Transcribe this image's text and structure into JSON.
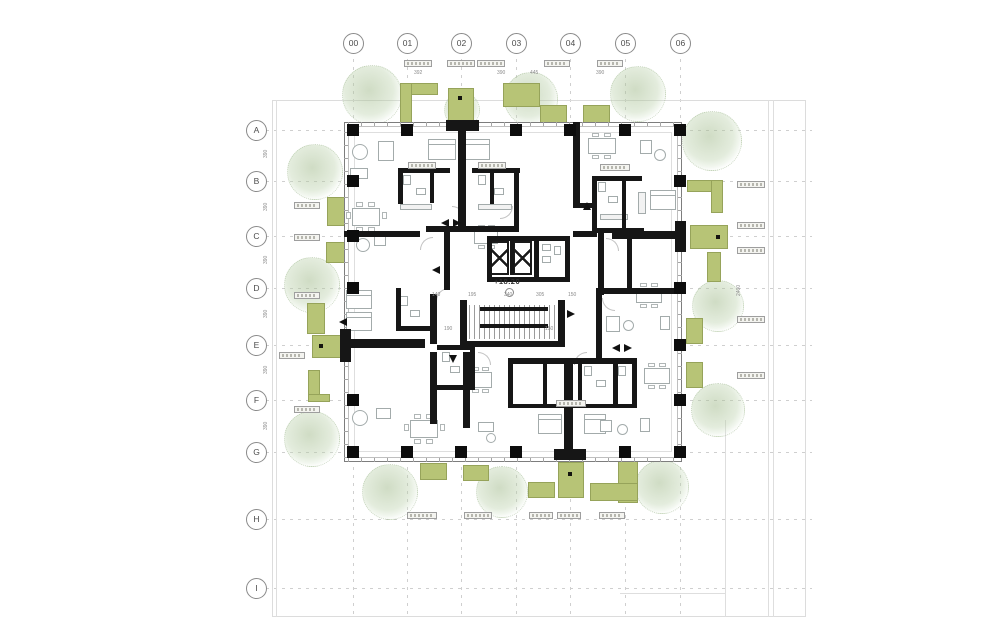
{
  "title": "residential-tower-floor-plan",
  "level_annotation": "+18.20",
  "grid": {
    "cols": [
      "00",
      "01",
      "02",
      "03",
      "04",
      "05",
      "06"
    ],
    "rows": [
      "A",
      "B",
      "C",
      "D",
      "E",
      "F",
      "G",
      "H",
      "I"
    ],
    "col_x": [
      353,
      407,
      461,
      516,
      570,
      625,
      680
    ],
    "row_y": [
      130,
      181,
      236,
      288,
      345,
      400,
      452,
      519,
      588
    ],
    "circle_top_cy": 43,
    "circle_left_cx": 256
  },
  "site": {
    "rect": [
      272,
      100,
      534,
      517
    ],
    "vlines": [
      [
        276,
        100,
        517
      ],
      [
        768,
        100,
        517
      ],
      [
        773,
        100,
        517
      ],
      [
        725,
        420,
        197
      ]
    ],
    "hlines": [
      [
        620,
        593,
        105
      ]
    ]
  },
  "building": {
    "rect": [
      344,
      122,
      338,
      340
    ]
  },
  "columns": [
    [
      407,
      130
    ],
    [
      516,
      130
    ],
    [
      570,
      130
    ],
    [
      625,
      130
    ],
    [
      353,
      130
    ],
    [
      353,
      181
    ],
    [
      353,
      236
    ],
    [
      353,
      288
    ],
    [
      353,
      400
    ],
    [
      353,
      452
    ],
    [
      680,
      130
    ],
    [
      680,
      181
    ],
    [
      680,
      288
    ],
    [
      680,
      345
    ],
    [
      680,
      400
    ],
    [
      680,
      452
    ],
    [
      407,
      452
    ],
    [
      461,
      452
    ],
    [
      516,
      452
    ],
    [
      625,
      452
    ]
  ],
  "walls": [
    [
      446,
      120,
      33,
      11
    ],
    [
      458,
      131,
      8,
      98
    ],
    [
      340,
      329,
      11,
      33
    ],
    [
      351,
      339,
      74,
      9
    ],
    [
      675,
      221,
      11,
      31
    ],
    [
      612,
      231,
      63,
      8
    ],
    [
      554,
      449,
      32,
      11
    ],
    [
      564,
      363,
      9,
      88
    ],
    [
      398,
      168,
      52,
      5
    ],
    [
      472,
      168,
      48,
      5
    ],
    [
      398,
      168,
      5,
      36
    ],
    [
      430,
      173,
      4,
      30
    ],
    [
      490,
      168,
      4,
      36
    ],
    [
      514,
      168,
      5,
      64
    ],
    [
      344,
      231,
      76,
      6
    ],
    [
      426,
      226,
      92,
      6
    ],
    [
      444,
      232,
      6,
      58
    ],
    [
      573,
      122,
      7,
      84
    ],
    [
      573,
      203,
      22,
      5
    ],
    [
      592,
      176,
      50,
      5
    ],
    [
      592,
      176,
      5,
      57
    ],
    [
      622,
      181,
      4,
      52
    ],
    [
      592,
      228,
      52,
      5
    ],
    [
      598,
      233,
      6,
      62
    ],
    [
      573,
      231,
      24,
      6
    ],
    [
      627,
      233,
      5,
      55
    ],
    [
      596,
      288,
      86,
      6
    ],
    [
      596,
      294,
      6,
      64
    ],
    [
      487,
      236,
      83,
      5
    ],
    [
      487,
      277,
      83,
      5
    ],
    [
      487,
      236,
      5,
      46
    ],
    [
      534,
      236,
      5,
      46
    ],
    [
      565,
      236,
      5,
      46
    ],
    [
      510,
      241,
      4,
      34
    ],
    [
      460,
      300,
      7,
      46
    ],
    [
      558,
      300,
      7,
      46
    ],
    [
      460,
      341,
      105,
      6
    ],
    [
      430,
      294,
      7,
      50
    ],
    [
      344,
      339,
      76,
      8
    ],
    [
      430,
      352,
      7,
      72
    ],
    [
      396,
      288,
      5,
      42
    ],
    [
      396,
      326,
      38,
      5
    ],
    [
      437,
      345,
      38,
      5
    ],
    [
      470,
      345,
      5,
      44
    ],
    [
      437,
      385,
      38,
      5
    ],
    [
      463,
      352,
      7,
      76
    ],
    [
      508,
      358,
      124,
      6
    ],
    [
      508,
      358,
      5,
      50
    ],
    [
      543,
      363,
      4,
      45
    ],
    [
      578,
      363,
      4,
      45
    ],
    [
      613,
      358,
      5,
      50
    ],
    [
      508,
      404,
      126,
      4
    ],
    [
      632,
      358,
      5,
      50
    ]
  ],
  "elevators": [
    [
      490,
      241,
      19,
      34
    ],
    [
      513,
      241,
      19,
      34
    ]
  ],
  "stairs": {
    "hatch": [
      469,
      305,
      88,
      34
    ],
    "bars": [
      [
        480,
        307,
        68,
        4
      ],
      [
        480,
        324,
        68,
        4
      ]
    ]
  },
  "level_pos": {
    "text_x": 494,
    "text_y": 277,
    "circ_x": 505,
    "circ_y": 288
  },
  "planters": [
    [
      400,
      83,
      38,
      12
    ],
    [
      400,
      83,
      12,
      40
    ],
    [
      448,
      88,
      26,
      58
    ],
    [
      503,
      83,
      37,
      24
    ],
    [
      540,
      105,
      27,
      25
    ],
    [
      583,
      105,
      27,
      25
    ],
    [
      687,
      180,
      36,
      12
    ],
    [
      711,
      180,
      12,
      33
    ],
    [
      690,
      225,
      38,
      24
    ],
    [
      707,
      252,
      14,
      30
    ],
    [
      686,
      318,
      17,
      26
    ],
    [
      686,
      362,
      17,
      26
    ],
    [
      327,
      197,
      20,
      29
    ],
    [
      326,
      242,
      21,
      21
    ],
    [
      307,
      303,
      18,
      31
    ],
    [
      312,
      335,
      33,
      23
    ],
    [
      308,
      370,
      12,
      32
    ],
    [
      308,
      394,
      22,
      8
    ],
    [
      420,
      463,
      27,
      17
    ],
    [
      463,
      465,
      26,
      16
    ],
    [
      558,
      462,
      26,
      36
    ],
    [
      528,
      482,
      27,
      16
    ],
    [
      618,
      458,
      20,
      45
    ],
    [
      590,
      483,
      48,
      18
    ]
  ],
  "planter_dots": [
    [
      458,
      96
    ],
    [
      716,
      235
    ],
    [
      319,
      344
    ],
    [
      568,
      472
    ]
  ],
  "trees": [
    [
      372,
      95,
      30
    ],
    [
      531,
      99,
      27
    ],
    [
      638,
      94,
      28
    ],
    [
      462,
      110,
      18
    ],
    [
      315,
      172,
      28
    ],
    [
      312,
      285,
      28
    ],
    [
      312,
      439,
      28
    ],
    [
      712,
      141,
      30
    ],
    [
      718,
      306,
      26
    ],
    [
      718,
      410,
      27
    ],
    [
      390,
      492,
      28
    ],
    [
      502,
      492,
      26
    ],
    [
      662,
      487,
      27
    ]
  ],
  "furniture": [
    [
      352,
      144,
      16,
      16,
      "o"
    ],
    [
      378,
      141,
      16,
      20,
      "r"
    ],
    [
      350,
      168,
      18,
      11,
      "r"
    ],
    [
      352,
      208,
      28,
      18,
      "r"
    ],
    [
      356,
      202,
      7,
      5,
      "c"
    ],
    [
      368,
      202,
      7,
      5,
      "c"
    ],
    [
      356,
      227,
      7,
      5,
      "c"
    ],
    [
      368,
      227,
      7,
      5,
      "c"
    ],
    [
      346,
      212,
      5,
      7,
      "c"
    ],
    [
      382,
      212,
      5,
      7,
      "c"
    ],
    [
      428,
      139,
      28,
      21,
      "b"
    ],
    [
      462,
      139,
      28,
      21,
      "b"
    ],
    [
      400,
      204,
      32,
      6,
      "k"
    ],
    [
      478,
      204,
      34,
      6,
      "k"
    ],
    [
      403,
      175,
      8,
      10,
      "r"
    ],
    [
      416,
      188,
      10,
      7,
      "r"
    ],
    [
      478,
      175,
      8,
      10,
      "r"
    ],
    [
      494,
      188,
      10,
      7,
      "r"
    ],
    [
      588,
      138,
      28,
      16,
      "r"
    ],
    [
      592,
      133,
      7,
      4,
      "c"
    ],
    [
      604,
      133,
      7,
      4,
      "c"
    ],
    [
      592,
      155,
      7,
      4,
      "c"
    ],
    [
      604,
      155,
      7,
      4,
      "c"
    ],
    [
      640,
      140,
      12,
      14,
      "r"
    ],
    [
      654,
      149,
      12,
      12,
      "o"
    ],
    [
      650,
      190,
      26,
      20,
      "b"
    ],
    [
      638,
      192,
      8,
      22,
      "k"
    ],
    [
      598,
      182,
      8,
      10,
      "r"
    ],
    [
      608,
      196,
      10,
      7,
      "r"
    ],
    [
      600,
      214,
      28,
      6,
      "k"
    ],
    [
      356,
      238,
      14,
      14,
      "o"
    ],
    [
      374,
      236,
      12,
      10,
      "r"
    ],
    [
      474,
      230,
      24,
      14,
      "r"
    ],
    [
      478,
      225,
      7,
      4,
      "c"
    ],
    [
      488,
      225,
      7,
      4,
      "c"
    ],
    [
      478,
      245,
      7,
      4,
      "c"
    ],
    [
      488,
      245,
      7,
      4,
      "c"
    ],
    [
      346,
      290,
      26,
      19,
      "b"
    ],
    [
      346,
      312,
      26,
      19,
      "b"
    ],
    [
      636,
      288,
      26,
      15,
      "r"
    ],
    [
      640,
      283,
      7,
      4,
      "c"
    ],
    [
      651,
      283,
      7,
      4,
      "c"
    ],
    [
      640,
      304,
      7,
      4,
      "c"
    ],
    [
      651,
      304,
      7,
      4,
      "c"
    ],
    [
      606,
      316,
      14,
      16,
      "r"
    ],
    [
      623,
      320,
      11,
      11,
      "o"
    ],
    [
      660,
      316,
      10,
      14,
      "r"
    ],
    [
      352,
      410,
      16,
      16,
      "o"
    ],
    [
      376,
      408,
      15,
      11,
      "r"
    ],
    [
      410,
      420,
      28,
      18,
      "r"
    ],
    [
      414,
      414,
      7,
      5,
      "c"
    ],
    [
      426,
      414,
      7,
      5,
      "c"
    ],
    [
      414,
      439,
      7,
      5,
      "c"
    ],
    [
      426,
      439,
      7,
      5,
      "c"
    ],
    [
      404,
      424,
      5,
      7,
      "c"
    ],
    [
      440,
      424,
      5,
      7,
      "c"
    ],
    [
      478,
      422,
      16,
      10,
      "r"
    ],
    [
      486,
      433,
      10,
      10,
      "o"
    ],
    [
      468,
      372,
      24,
      16,
      "r"
    ],
    [
      472,
      367,
      7,
      4,
      "c"
    ],
    [
      482,
      367,
      7,
      4,
      "c"
    ],
    [
      472,
      389,
      7,
      4,
      "c"
    ],
    [
      482,
      389,
      7,
      4,
      "c"
    ],
    [
      538,
      414,
      24,
      20,
      "b"
    ],
    [
      584,
      414,
      22,
      20,
      "b"
    ],
    [
      600,
      420,
      12,
      12,
      "r"
    ],
    [
      617,
      424,
      11,
      11,
      "o"
    ],
    [
      640,
      418,
      10,
      14,
      "r"
    ],
    [
      644,
      368,
      26,
      16,
      "r"
    ],
    [
      648,
      363,
      7,
      4,
      "c"
    ],
    [
      659,
      363,
      7,
      4,
      "c"
    ],
    [
      648,
      385,
      7,
      4,
      "c"
    ],
    [
      659,
      385,
      7,
      4,
      "c"
    ],
    [
      542,
      244,
      9,
      7,
      "r"
    ],
    [
      542,
      256,
      9,
      7,
      "r"
    ],
    [
      554,
      246,
      7,
      9,
      "r"
    ],
    [
      584,
      366,
      8,
      10,
      "r"
    ],
    [
      596,
      380,
      10,
      7,
      "r"
    ],
    [
      618,
      366,
      8,
      10,
      "r"
    ],
    [
      400,
      296,
      8,
      10,
      "r"
    ],
    [
      410,
      310,
      10,
      7,
      "r"
    ],
    [
      442,
      352,
      8,
      10,
      "r"
    ],
    [
      450,
      366,
      10,
      7,
      "r"
    ]
  ],
  "arcs": [
    [
      420,
      237,
      0
    ],
    [
      452,
      206,
      90
    ],
    [
      500,
      206,
      180
    ],
    [
      602,
      298,
      270
    ],
    [
      574,
      352,
      0
    ],
    [
      478,
      352,
      90
    ],
    [
      436,
      288,
      0
    ],
    [
      606,
      238,
      90
    ]
  ],
  "arrows": [
    [
      441,
      219,
      "l"
    ],
    [
      453,
      219,
      "r"
    ],
    [
      432,
      266,
      "l"
    ],
    [
      567,
      310,
      "r"
    ],
    [
      449,
      355,
      "d"
    ],
    [
      583,
      202,
      "u"
    ],
    [
      612,
      344,
      "l"
    ],
    [
      624,
      344,
      "r"
    ],
    [
      339,
      318,
      "l"
    ]
  ],
  "annotation_boxes": [
    [
      404,
      60,
      28
    ],
    [
      447,
      60,
      28
    ],
    [
      477,
      60,
      28
    ],
    [
      544,
      60,
      26
    ],
    [
      597,
      60,
      26
    ],
    [
      407,
      512,
      30
    ],
    [
      464,
      512,
      28
    ],
    [
      529,
      512,
      24
    ],
    [
      557,
      512,
      24
    ],
    [
      599,
      512,
      26
    ],
    [
      294,
      202,
      26
    ],
    [
      294,
      234,
      26
    ],
    [
      294,
      292,
      26
    ],
    [
      279,
      352,
      26
    ],
    [
      294,
      406,
      26
    ],
    [
      737,
      181,
      28
    ],
    [
      737,
      222,
      28
    ],
    [
      737,
      247,
      28
    ],
    [
      737,
      316,
      28
    ],
    [
      737,
      372,
      28
    ],
    [
      408,
      162,
      28
    ],
    [
      478,
      162,
      28
    ],
    [
      600,
      164,
      30
    ],
    [
      556,
      400,
      30
    ]
  ],
  "dimensions": [
    [
      414,
      71,
      "392",
      0
    ],
    [
      497,
      71,
      "390",
      0
    ],
    [
      530,
      71,
      "445",
      0
    ],
    [
      596,
      71,
      "390",
      0
    ],
    [
      432,
      293,
      "140",
      0
    ],
    [
      468,
      293,
      "195",
      0
    ],
    [
      504,
      293,
      "340",
      0
    ],
    [
      536,
      293,
      "305",
      0
    ],
    [
      568,
      293,
      "150",
      0
    ],
    [
      444,
      327,
      "190",
      0
    ],
    [
      545,
      327,
      "150",
      0
    ],
    [
      264,
      158,
      "390",
      1
    ],
    [
      264,
      211,
      "390",
      1
    ],
    [
      264,
      264,
      "390",
      1
    ],
    [
      264,
      318,
      "390",
      1
    ],
    [
      264,
      374,
      "390",
      1
    ],
    [
      264,
      430,
      "390",
      1
    ],
    [
      737,
      296,
      "2400",
      1
    ]
  ]
}
